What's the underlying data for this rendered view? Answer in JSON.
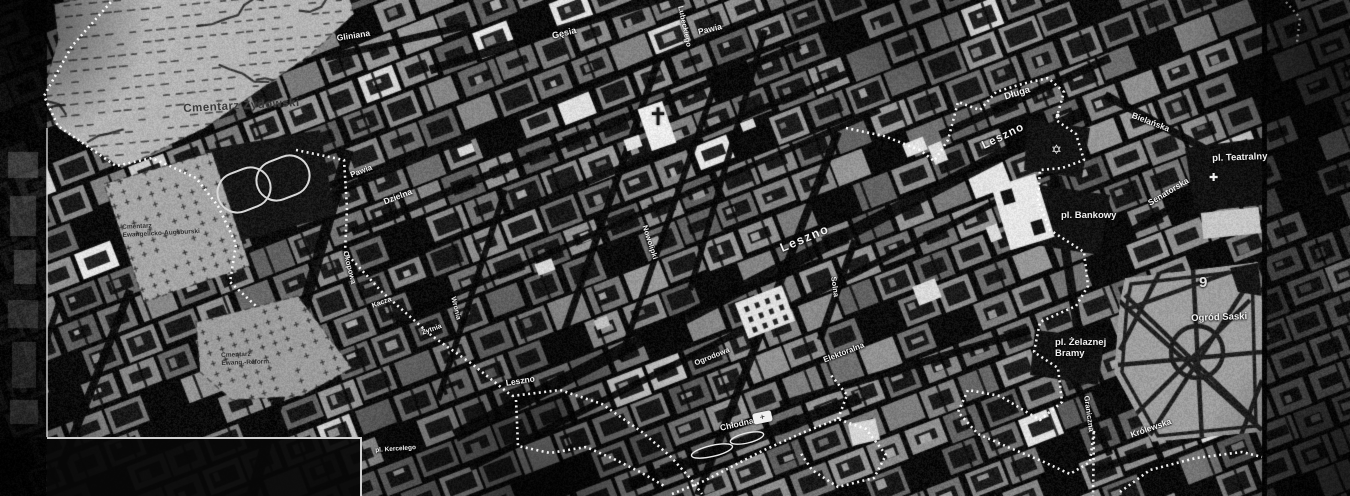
{
  "map": {
    "colors": {
      "background": "#0b0b0b",
      "block": "#8a8a8a",
      "street": "#0e0e0e",
      "boundary": "#ffffff",
      "cemetery": "#b4b4b4",
      "label": "#f2f2f2",
      "label_dark": "#2f2f2f"
    },
    "labels": [
      {
        "id": "cmentarz-zydowski",
        "text": "Cmentarz Żydowski",
        "x": 183,
        "y": 103,
        "rot": -3,
        "size": 11.5,
        "color": "#3a3a3a",
        "ls": 0.5,
        "dark": true
      },
      {
        "id": "cmentarz-ewangelicko-augsburski",
        "lines": [
          "Cmentarz",
          "Ewangelicko-Augsburski"
        ],
        "x": 122,
        "y": 224,
        "rot": -3,
        "size": 6.5,
        "color": "#2e2e2e",
        "dark": true
      },
      {
        "id": "cmentarz-ewang-reform",
        "lines": [
          "Cmentarz",
          "Ewang.-Reform."
        ],
        "x": 221,
        "y": 352,
        "rot": -2,
        "size": 6.5,
        "color": "#2e2e2e",
        "dark": true
      },
      {
        "id": "gliniana",
        "text": "Gliniana",
        "x": 336,
        "y": 33,
        "rot": -9,
        "size": 8.5
      },
      {
        "id": "gesia",
        "text": "Gęsia",
        "x": 551,
        "y": 31,
        "rot": -14,
        "size": 9
      },
      {
        "id": "lubeckiego",
        "text": "Lubeckiego",
        "x": 685,
        "y": 5,
        "rot": 78,
        "size": 7.5
      },
      {
        "id": "pawia-north",
        "text": "Pawia",
        "x": 697,
        "y": 27,
        "rot": -14,
        "size": 8.5
      },
      {
        "id": "pawia-west",
        "text": "Pawia",
        "x": 349,
        "y": 171,
        "rot": -21,
        "size": 8
      },
      {
        "id": "dzielna",
        "text": "Dzielna",
        "x": 382,
        "y": 197,
        "rot": -21,
        "size": 8.5
      },
      {
        "id": "nowolipki",
        "text": "Nowolipki",
        "x": 649,
        "y": 224,
        "rot": 72,
        "size": 7.5
      },
      {
        "id": "okopowa",
        "text": "Okopowa",
        "x": 350,
        "y": 250,
        "rot": 76,
        "size": 7.5
      },
      {
        "id": "wronia",
        "text": "Wronia",
        "x": 456,
        "y": 296,
        "rot": 76,
        "size": 7
      },
      {
        "id": "kacza",
        "text": "Kacza",
        "x": 371,
        "y": 303,
        "rot": -20,
        "size": 7
      },
      {
        "id": "zytnia",
        "text": "Żytnia",
        "x": 421,
        "y": 330,
        "rot": -20,
        "size": 7
      },
      {
        "id": "leszno-west",
        "text": "Leszno",
        "x": 505,
        "y": 378,
        "rot": -9,
        "size": 8.5
      },
      {
        "id": "leszno-central",
        "text": "Leszno",
        "x": 778,
        "y": 242,
        "rot": -23,
        "size": 12.5,
        "ls": 1.5
      },
      {
        "id": "leszno-east",
        "text": "Leszno",
        "x": 980,
        "y": 141,
        "rot": -26,
        "size": 11.5,
        "ls": 1
      },
      {
        "id": "ogrodowa",
        "text": "Ogrodowa",
        "x": 693,
        "y": 359,
        "rot": -22,
        "size": 7.5
      },
      {
        "id": "chlodna",
        "text": "Chłodna",
        "x": 719,
        "y": 423,
        "rot": -13,
        "size": 8.5
      },
      {
        "id": "solna",
        "text": "Solna",
        "x": 838,
        "y": 276,
        "rot": 82,
        "size": 7.5
      },
      {
        "id": "elektoralna",
        "text": "Elektoralna",
        "x": 822,
        "y": 356,
        "rot": -21,
        "size": 8
      },
      {
        "id": "dluga",
        "text": "Długa",
        "x": 1003,
        "y": 92,
        "rot": -17,
        "size": 9.5
      },
      {
        "id": "bielanska",
        "text": "Bielańska",
        "x": 1134,
        "y": 110,
        "rot": 21,
        "size": 8.5
      },
      {
        "id": "pl-teatralny",
        "text": "pl. Teatralny",
        "x": 1212,
        "y": 153,
        "rot": -2,
        "size": 9.5
      },
      {
        "id": "senatorska",
        "text": "Senatorska",
        "x": 1146,
        "y": 199,
        "rot": -31,
        "size": 8.5
      },
      {
        "id": "pl-bankowy",
        "text": "pl. Bankowy",
        "x": 1061,
        "y": 210,
        "rot": 0,
        "size": 9.5
      },
      {
        "id": "pl-zelaznej-bramy",
        "lines": [
          "pl. Żelaznej",
          "Bramy"
        ],
        "x": 1055,
        "y": 337,
        "rot": 0,
        "size": 9.5
      },
      {
        "id": "ogrod-saski",
        "text": "Ogród Saski",
        "x": 1191,
        "y": 313,
        "rot": -2,
        "size": 9.5
      },
      {
        "id": "graniczna",
        "text": "Graniczna",
        "x": 1091,
        "y": 395,
        "rot": 82,
        "size": 7.5
      },
      {
        "id": "krolewska",
        "text": "Królewska",
        "x": 1129,
        "y": 430,
        "rot": -19,
        "size": 8.5
      },
      {
        "id": "pl-kercelego",
        "text": "pl. Kercelego",
        "x": 375,
        "y": 447,
        "rot": -4,
        "size": 6.5
      },
      {
        "id": "district-9",
        "text": "9",
        "x": 1199,
        "y": 274,
        "rot": 0,
        "size": 15,
        "color": "#e0e0e0"
      }
    ],
    "markers": [
      {
        "id": "synagogue-star-icon",
        "glyph": "✡",
        "x": 1051,
        "y": 143,
        "size": 13,
        "color": "#f5f5f5"
      },
      {
        "id": "round-marker-icon",
        "glyph": "●",
        "x": 1055,
        "y": 111,
        "size": 9,
        "color": "#f0f0f0"
      },
      {
        "id": "church-marker-chlodna-icon",
        "glyph": "+",
        "x": 752,
        "y": 414,
        "size": 9,
        "chip": true,
        "rot": -12,
        "color": "#141414"
      },
      {
        "id": "cross-marker-teatralny-icon",
        "glyph": "✚",
        "x": 1209,
        "y": 173,
        "size": 11,
        "color": "#f0f0f0"
      },
      {
        "id": "church-cross-dzielna-icon",
        "glyph": "✝",
        "x": 648,
        "y": 106,
        "size": 24,
        "color": "#1a1a1a"
      }
    ]
  }
}
